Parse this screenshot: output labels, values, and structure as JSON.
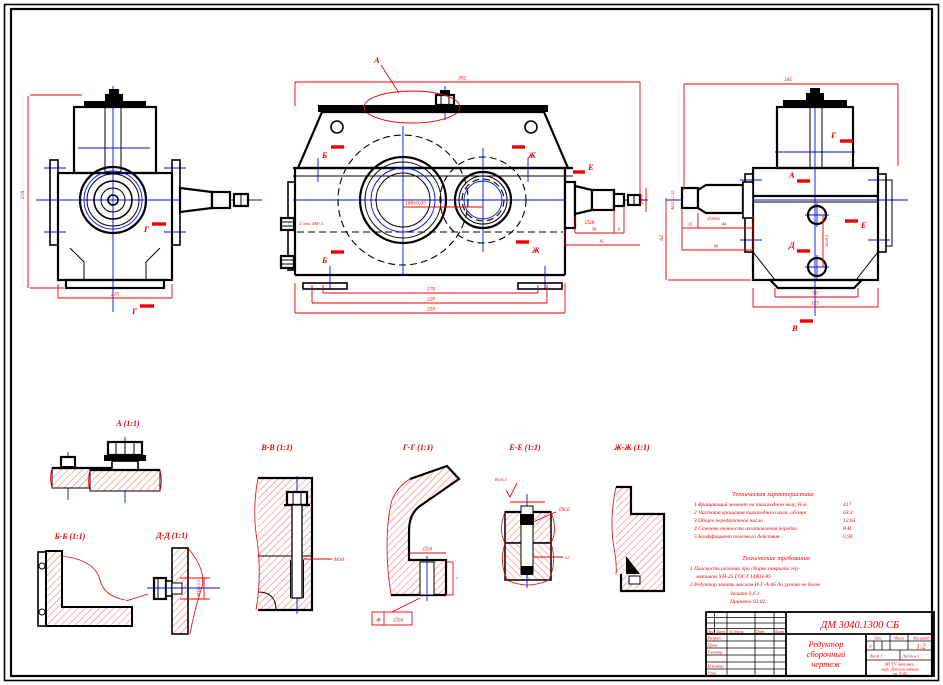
{
  "colors": {
    "line": "#000000",
    "dimension": "#f00000",
    "centerline": "#0010ee",
    "paper": "#ffffff"
  },
  "marks": {
    "a": "А",
    "b": "Б",
    "v": "В",
    "g": "Г",
    "d": "Д",
    "e": "Е",
    "zh": "Ж"
  },
  "details": {
    "a": "А (1:1)",
    "bb": "Б-Б (1:1)",
    "vv": "В-В (1:1)",
    "gg": "Г-Г (1:1)",
    "dd": "Д-Д (1:1)",
    "ee": "Е-Е (1:1)",
    "zhzh": "Ж-Ж (1:1)"
  },
  "dims": {
    "left_height": "218",
    "left_width": "210",
    "main_top": "302",
    "main_cd": "160±0,05",
    "main_b1": "170",
    "main_b2": "220",
    "main_b3": "250",
    "shaft_d": "∅28",
    "shaft_end_d": "∅18",
    "shaft_l1": "58",
    "shaft_l2": "8",
    "shaft_l3": "82",
    "oil_plugs": "2 отв. М8×1",
    "right_top": "185",
    "right_left": "82",
    "right_b1": "90",
    "right_b2": "125",
    "right_holes": "52±0,3",
    "right_shaft_thread": "М12×1,25",
    "right_shaft_d": "∅18к6",
    "right_l1": "16",
    "right_l2": "44",
    "right_l3": "98",
    "vv_leader": "М10",
    "dd_thread": "М16×1,5",
    "gg_d": "∅24",
    "gg_h": "7",
    "gg_frame_sym": "⊕",
    "gg_frame_val": "∅26",
    "ee_ra": "Ra 6,3",
    "ee_d": "∅6,6",
    "ee_l": "12"
  },
  "tech_char": {
    "title": "Техническая характеристика",
    "items": [
      {
        "t": "1 Вращающий момент на тихоходном валу, Н·м",
        "v": "417"
      },
      {
        "t": "2 Частота вращения тихоходного вала, об/мин",
        "v": "63,3"
      },
      {
        "t": "3 Общее передаточное число",
        "v": "12,63"
      },
      {
        "t": "4 Степень точности изготовления передач",
        "v": "8-В"
      },
      {
        "t": "5 Коэффициент полезного действия",
        "v": "0,96"
      }
    ]
  },
  "tech_req": {
    "title": "Технические требования",
    "lines": [
      "1 Плоскость разъема при сборке покрыть гер-",
      "метиком УН-25 ГОСТ 14803-85",
      "2 Редуктор залить маслом И-Г-А-46 до уровня не более",
      "Залито   3,6 л",
      "Принято   02.02."
    ]
  },
  "title_block": {
    "doc_number": "ДМ 3040.1300 СБ",
    "name_line1": "Редуктор",
    "name_line2": "сборочный",
    "name_line3": "чертеж",
    "scale": "1:2",
    "lit": "У",
    "headers": {
      "izm": "Изм.",
      "list": "Лист",
      "doc": "№ докум.",
      "podp": "Подп.",
      "data": "Дата",
      "lit": "Лит.",
      "massa": "Масса",
      "masshtab": "Масштаб",
      "list2": "Лист 1",
      "listov": "Листов 1"
    },
    "rows": {
      "razrab": "Разраб.",
      "prov": "Пров.",
      "tkontr": "Т.контр.",
      "nkontr": "Н.контр.",
      "utv": "Утв."
    },
    "org_line1": "МГТУ Автомех.",
    "org_line2": "каф. Детали машин",
    "org_line3": "гр. 3-42"
  }
}
